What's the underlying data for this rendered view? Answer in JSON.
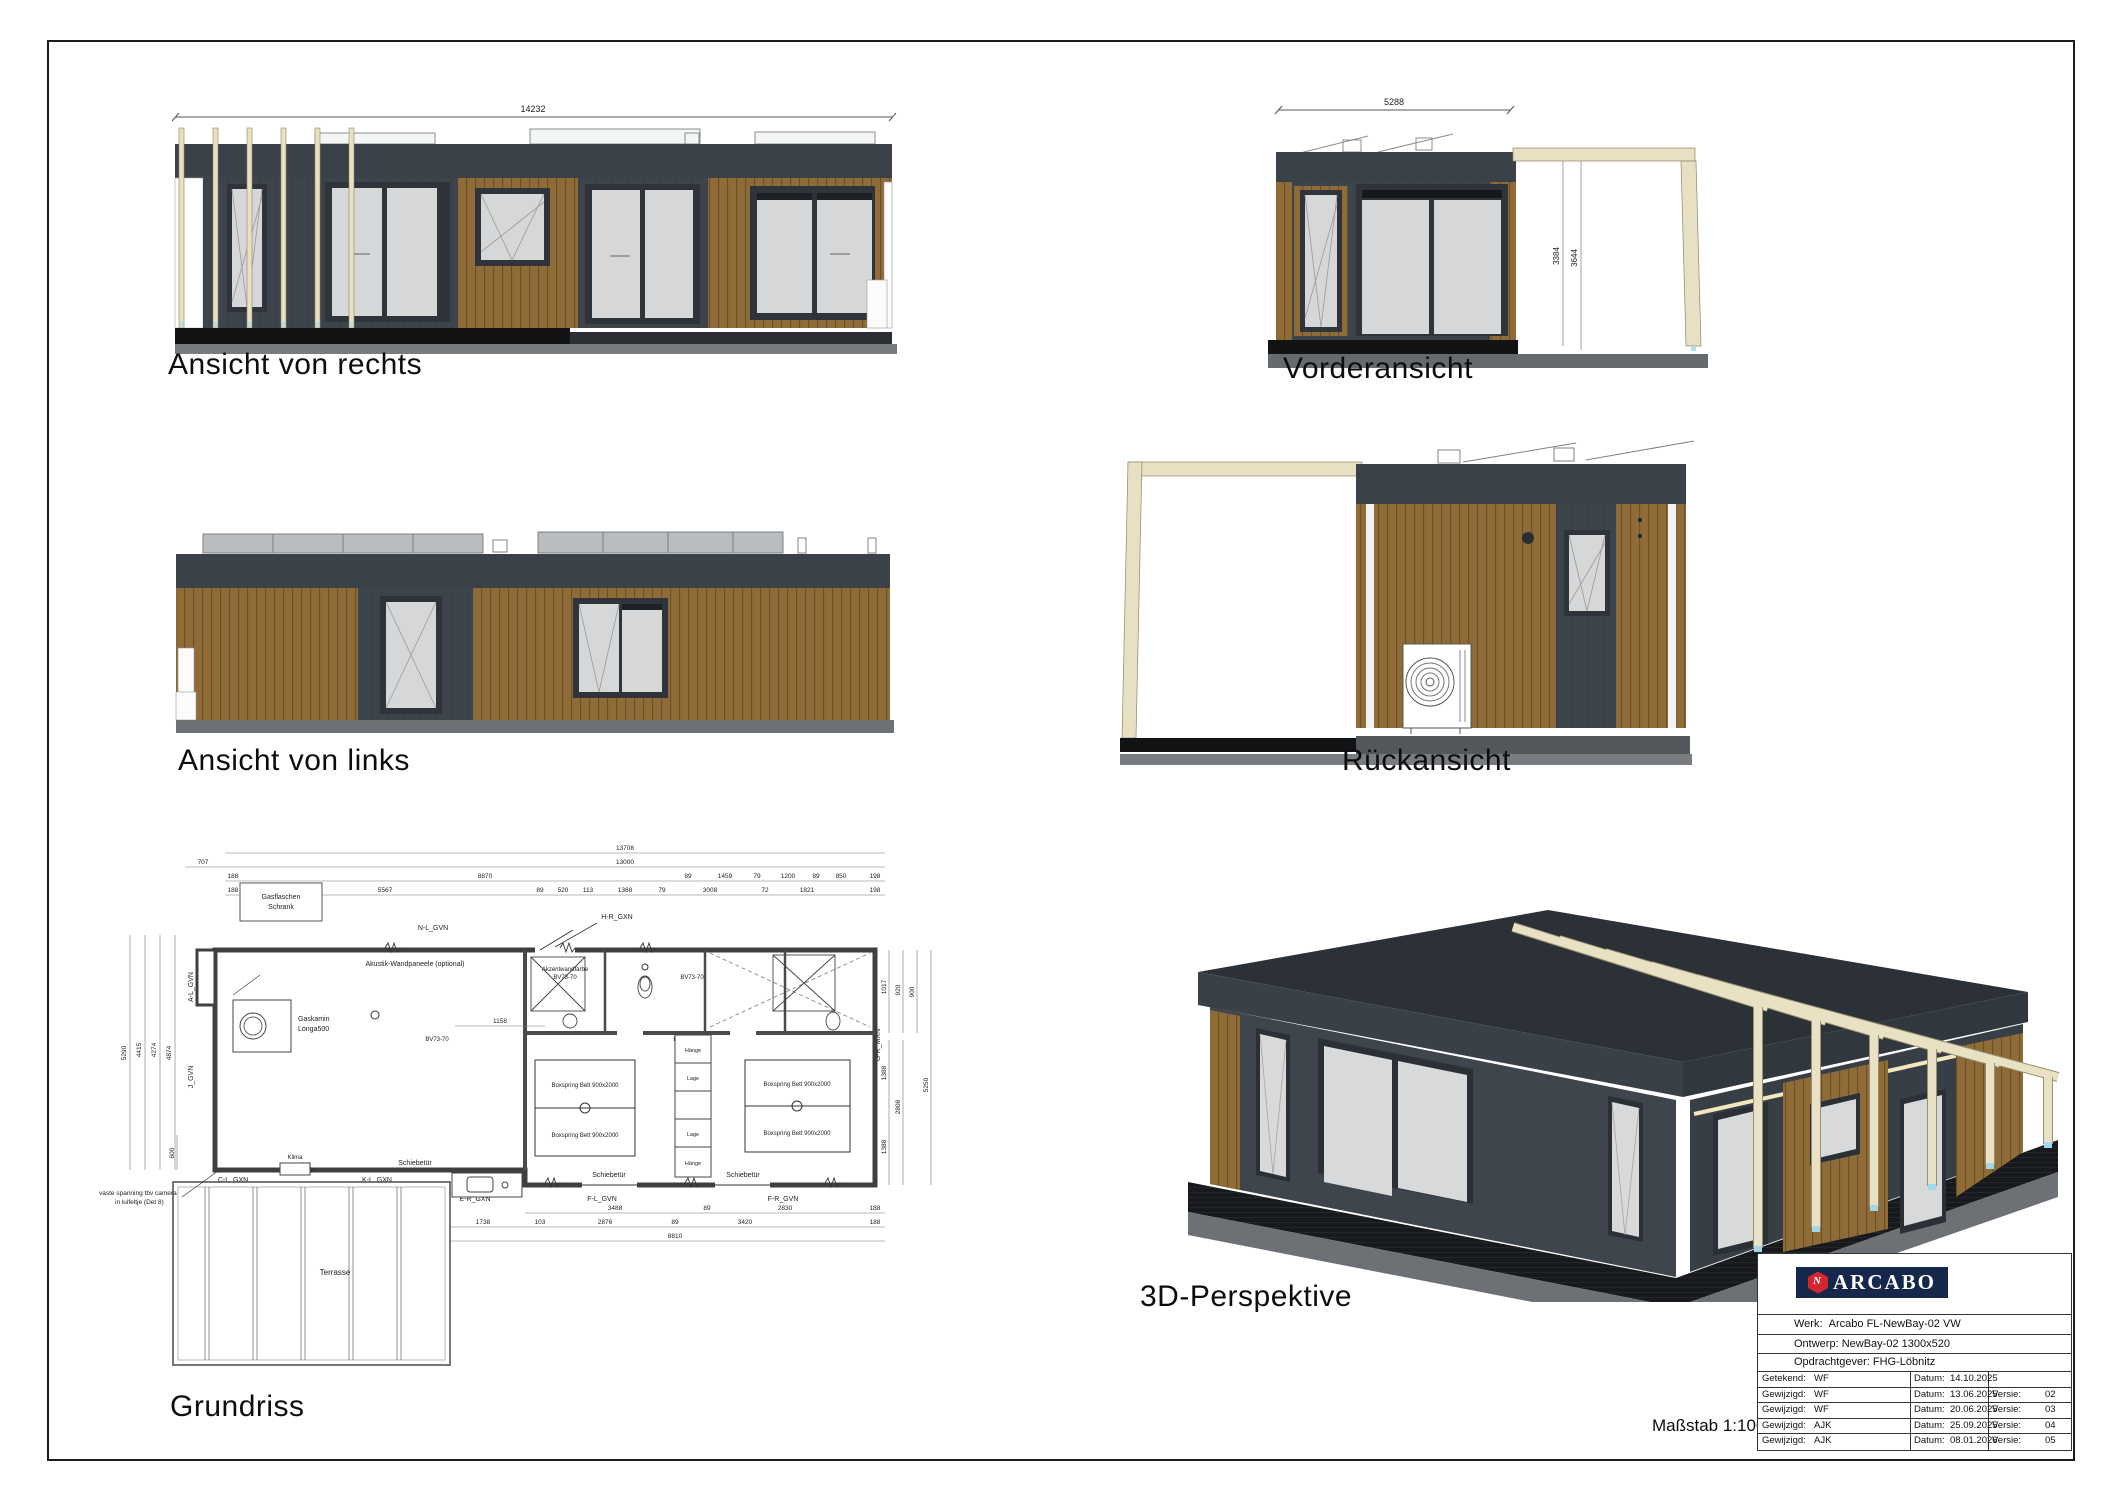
{
  "sheet": {
    "scale_label": "Maßstab 1:100"
  },
  "views": {
    "right": {
      "title": "Ansicht von rechts",
      "dim": "14232"
    },
    "front": {
      "title": "Vorderansicht",
      "dim": "5288",
      "h1": "3384",
      "h2": "3644"
    },
    "left": {
      "title": "Ansicht von links"
    },
    "back": {
      "title": "Rückansicht"
    },
    "plan": {
      "title": "Grundriss"
    },
    "persp": {
      "title": "3D-Perspektive"
    }
  },
  "plan": {
    "top1": "13708",
    "top2a": "707",
    "top2b": "13000",
    "top3": [
      "188",
      "8870",
      "89",
      "1459",
      "79",
      "1200",
      "89",
      "850",
      "198"
    ],
    "top4": [
      "188",
      "5567",
      "89",
      "520",
      "113",
      "1368",
      "79",
      "3008",
      "72",
      "1821",
      "198"
    ],
    "left_v": [
      "5290",
      "4415",
      "4274",
      "4874"
    ],
    "left_low": [
      "600",
      "3000"
    ],
    "right_v": [
      "1017",
      "920",
      "900",
      "1388",
      "2808",
      "1388",
      "5250"
    ],
    "bot1": [
      "3488",
      "89",
      "2830",
      "188"
    ],
    "bot2": [
      "1738",
      "103",
      "2876",
      "89",
      "3420",
      "188"
    ],
    "bot3": "8810",
    "mid_dim": "1158",
    "labels": {
      "gas1": "Gasflaschen",
      "gas2": "Schrank",
      "acoustic": "Akustik-Wandpaneele (optional)",
      "fire1": "Gaskamin",
      "fire2": "Longa500",
      "accent": "Akzentwandfarbe",
      "accent_code": "BV73-70",
      "bed": "Boxspring Bett 900x2000",
      "sliding": "Schiebetür",
      "terrace": "Terrasse",
      "klima": "Klima",
      "hang": "Hänge",
      "shelf": "Lage",
      "note1": "vaste spanning tbv camera",
      "note2": "in luifeltje (Det 8)"
    },
    "modules": {
      "nl": "N-L_GVN",
      "hr": "H-R_GXN",
      "al": "A-L_GVN",
      "j": "J_GVN",
      "cl": "C-L_GXN",
      "kl": "K-L_GXN",
      "er": "E-R_GXN",
      "fl": "F-L_GVN",
      "fr": "F-R_GVN",
      "gr": "G-R_MXN"
    }
  },
  "titleblock": {
    "brand": "ARCABO",
    "werk_label": "Werk:",
    "werk_value": "Arcabo   FL-NewBay-02 VW",
    "ontwerp_label": "Ontwerp:",
    "ontwerp_value": "NewBay-02 1300x520",
    "client_label": "Opdrachtgever:",
    "client_value": "FHG-Löbnitz",
    "rows": [
      {
        "who_label": "Getekend:",
        "who": "WF",
        "datum_label": "Datum:",
        "datum": "14.10.2025",
        "versie_label": "",
        "versie": ""
      },
      {
        "who_label": "Gewijzigd:",
        "who": "WF",
        "datum_label": "Datum:",
        "datum": "13.06.2025",
        "versie_label": "Versie:",
        "versie": "02"
      },
      {
        "who_label": "Gewijzigd:",
        "who": "WF",
        "datum_label": "Datum:",
        "datum": "20.06.2025",
        "versie_label": "Versie:",
        "versie": "03"
      },
      {
        "who_label": "Gewijzigd:",
        "who": "AJK",
        "datum_label": "Datum:",
        "datum": "25.09.2025",
        "versie_label": "Versie:",
        "versie": "04"
      },
      {
        "who_label": "Gewijzigd:",
        "who": "AJK",
        "datum_label": "Datum:",
        "datum": "08.01.2026",
        "versie_label": "Versie:",
        "versie": "05"
      }
    ]
  }
}
